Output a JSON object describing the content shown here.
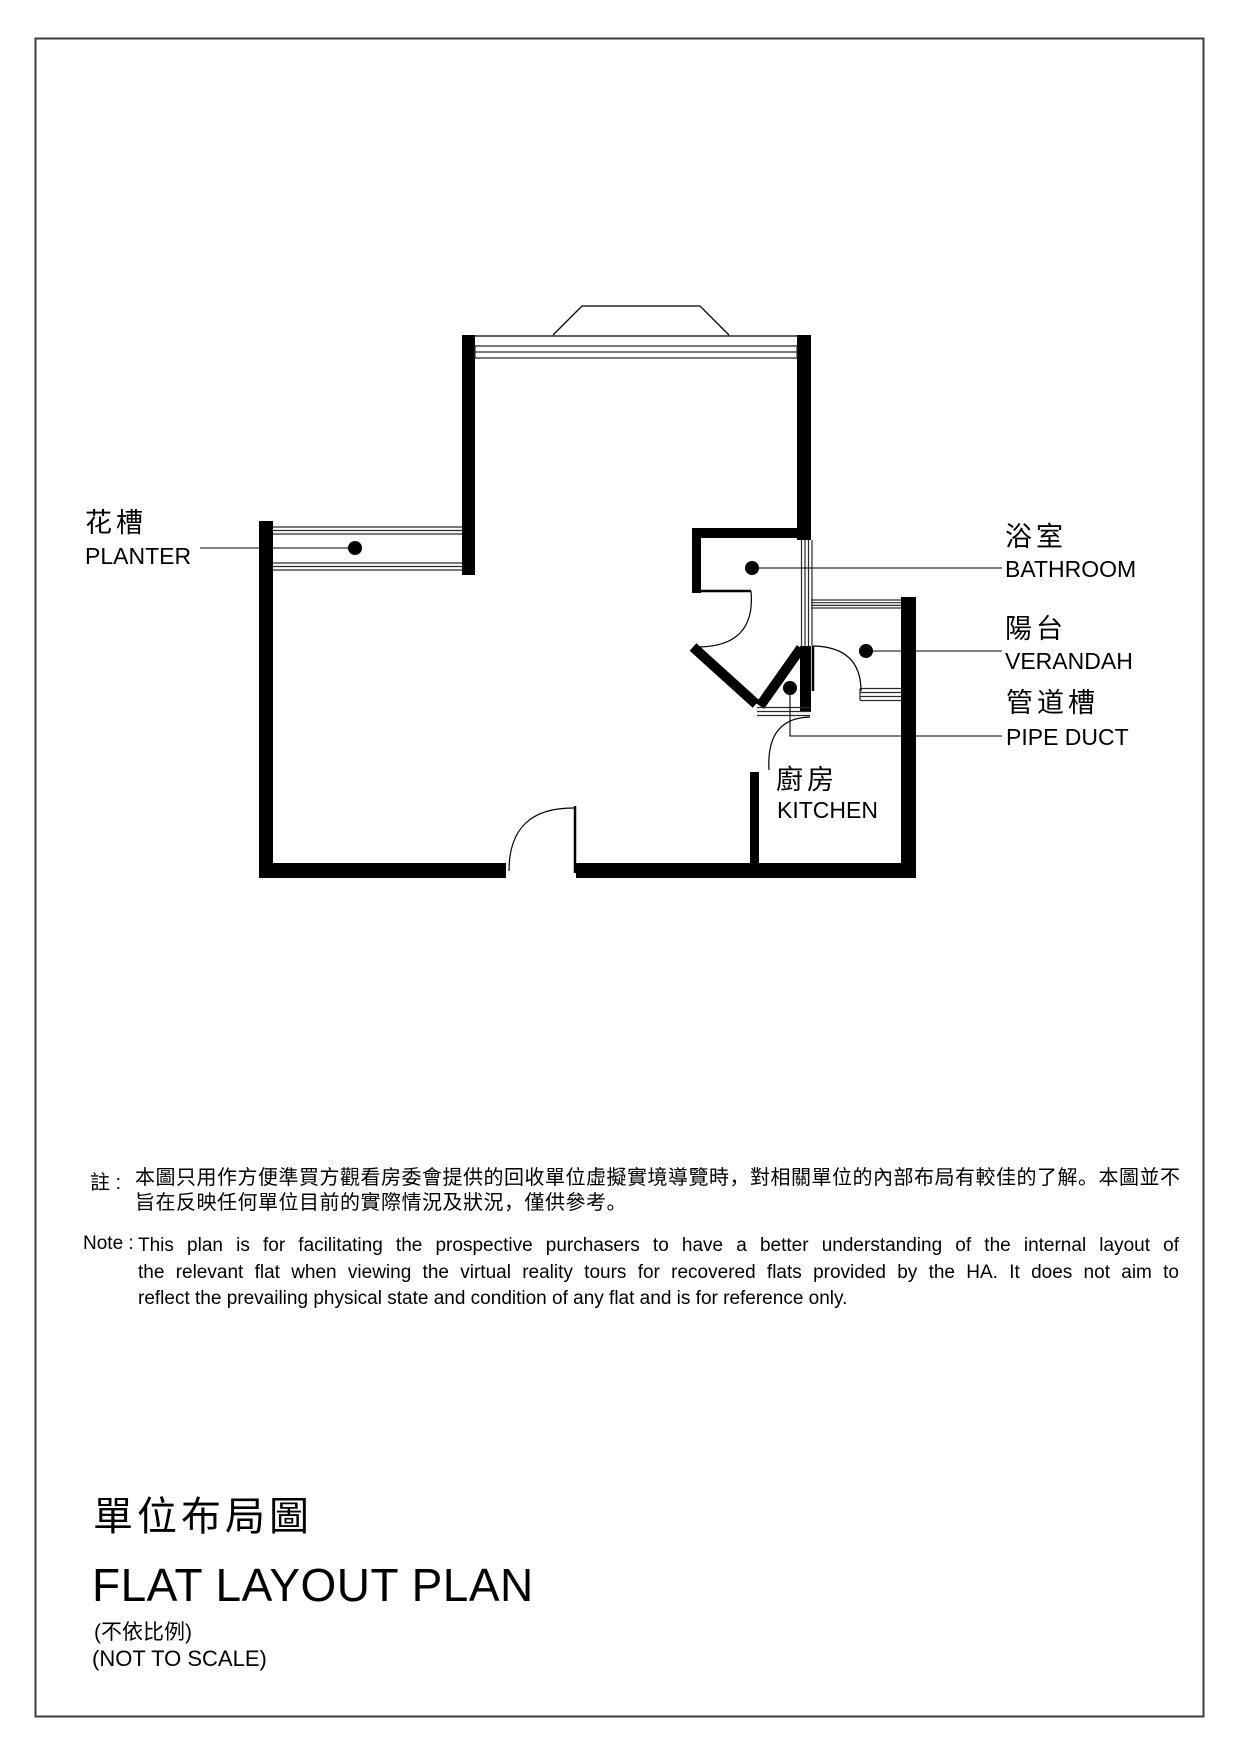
{
  "page": {
    "background": "#ffffff",
    "border_color": "#3c3c3c",
    "ink_color": "#000000"
  },
  "plan": {
    "labels": {
      "planter": {
        "zh": "花槽",
        "en": "PLANTER"
      },
      "bathroom": {
        "zh": "浴室",
        "en": "BATHROOM"
      },
      "verandah": {
        "zh": "陽台",
        "en": "VERANDAH"
      },
      "pipe_duct": {
        "zh": "管道槽",
        "en": "PIPE DUCT"
      },
      "kitchen": {
        "zh": "廚房",
        "en": "KITCHEN"
      }
    }
  },
  "notes": {
    "zh_label": "註 :",
    "zh_lines": [
      "本圖只用作方便準買方觀看房委會提供的回收單位虛擬實境導覽時，對相關單位的內部布局有較佳的了解。本圖並不",
      "旨在反映任何單位目前的實際情況及狀況，僅供參考。"
    ],
    "en_label": "Note :",
    "en_lines": [
      "This plan is for facilitating the prospective purchasers to have a better understanding of the internal layout of",
      "the relevant flat when viewing the virtual reality tours for recovered flats provided by the HA. It does not aim to",
      "reflect the prevailing physical state and condition of any flat and is for reference only."
    ]
  },
  "title": {
    "zh": "單位布局圖",
    "en": "FLAT LAYOUT PLAN",
    "scale_zh": "(不依比例)",
    "scale_en": "(NOT TO SCALE)"
  }
}
